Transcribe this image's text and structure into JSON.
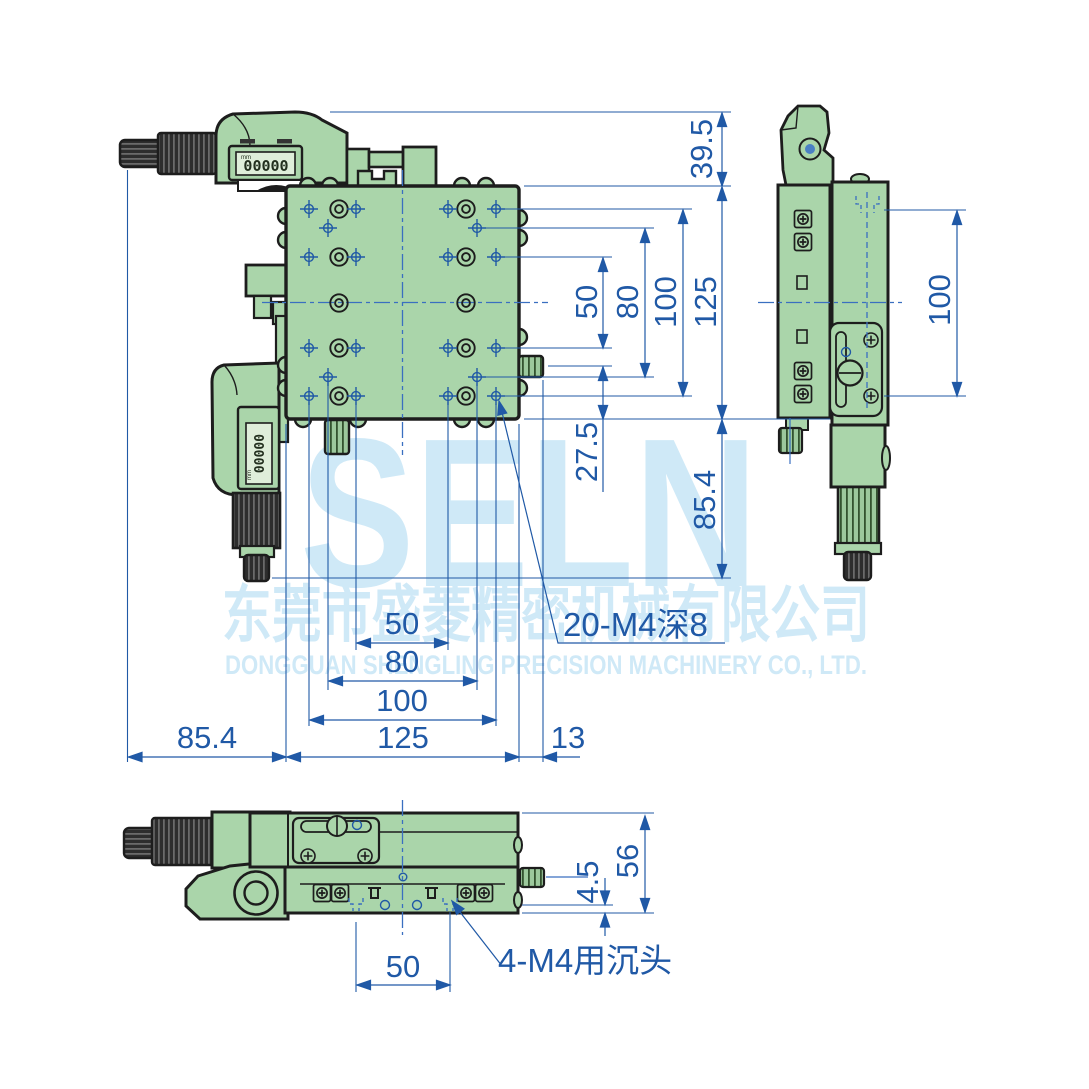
{
  "watermark": {
    "logo": "SELN",
    "company_cn": "东莞市盛菱精密机械有限公司",
    "company_en": "DONGGUAN SHENGLING PRECISION MACHINERY CO., LTD."
  },
  "display": {
    "digits": "00000",
    "unit": "mm"
  },
  "dims": {
    "d39_5": "39.5",
    "d50r": "50",
    "d80r": "80",
    "d100r": "100",
    "d125r": "125",
    "d27_5": "27.5",
    "d85_4r": "85.4",
    "side_d100": "100",
    "b50": "50",
    "b80": "80",
    "b100": "100",
    "b125": "125",
    "b85_4": "85.4",
    "b13": "13",
    "f56": "56",
    "f4_5": "4.5",
    "f50": "50"
  },
  "labels": {
    "tapped": "20-M4深8",
    "countersunk": "4-M4用沉头"
  },
  "colors": {
    "body_green": "#aad5aa",
    "outline": "#1d1d1d",
    "dimension_blue": "#2059a6",
    "watermark_blue": "#cfe9f7"
  }
}
